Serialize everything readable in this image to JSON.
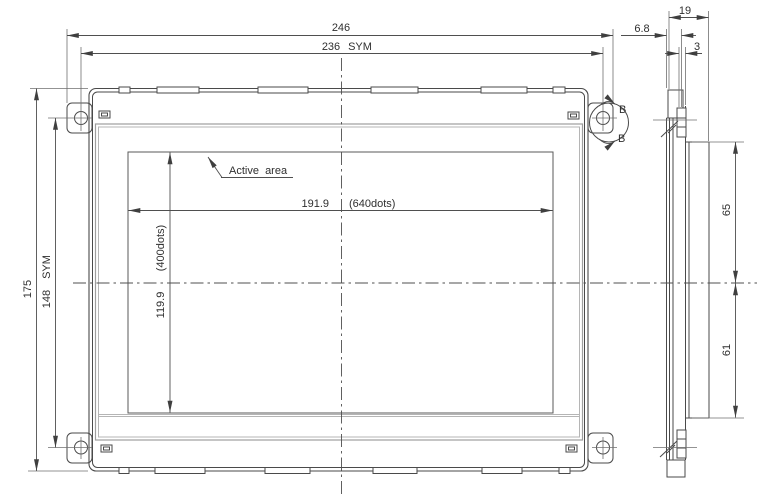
{
  "drawing": {
    "front_view": {
      "active_area_label": "Active  area",
      "detail_marker": "B",
      "dims": {
        "overall_width": "246",
        "mount_pitch_width": "236",
        "mount_pitch_width_note": "SYM",
        "overall_height": "175",
        "mount_pitch_height": "148",
        "mount_pitch_height_note": "SYM",
        "active_width": "191.9",
        "active_width_dots": "(640dots)",
        "active_height": "119.9",
        "active_height_dots": "(400dots)"
      }
    },
    "side_view": {
      "dims": {
        "depth_total": "19",
        "bezel_depth": "6.8",
        "mount_tab_offset": "3",
        "center_to_top_edge": "65",
        "center_to_bottom_edge": "61"
      }
    },
    "colors": {
      "outline": "#4a4a4a",
      "dimension_line": "#4f4f4f",
      "bezel_window": "#9e9e9e",
      "text": "#2f2f2f",
      "background": "#ffffff"
    }
  }
}
